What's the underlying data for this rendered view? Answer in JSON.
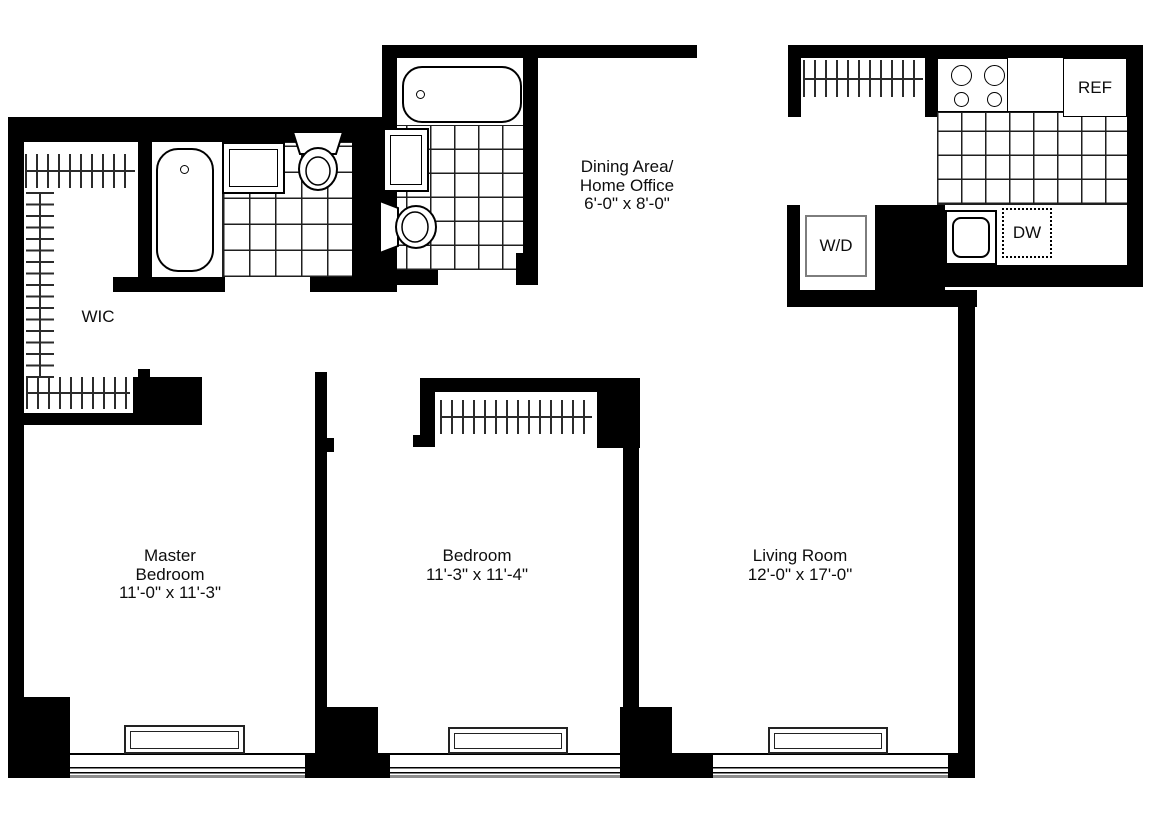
{
  "plan": {
    "wic": {
      "label": "WIC"
    },
    "dining_area": {
      "name_line1": "Dining Area/",
      "name_line2": "Home Office",
      "dimensions": "6'-0\" x 8'-0\""
    },
    "master_bedroom": {
      "name_line1": "Master",
      "name_line2": "Bedroom",
      "dimensions": "11'-0\" x 11'-3\""
    },
    "bedroom": {
      "name": "Bedroom",
      "dimensions": "11'-3\" x 11'-4\""
    },
    "living_room": {
      "name": "Living Room",
      "dimensions": "12'-0\" x 17'-0\""
    },
    "kitchen": {
      "refrigerator_label": "REF",
      "dishwasher_label": "DW",
      "washer_dryer_label": "W/D"
    }
  }
}
